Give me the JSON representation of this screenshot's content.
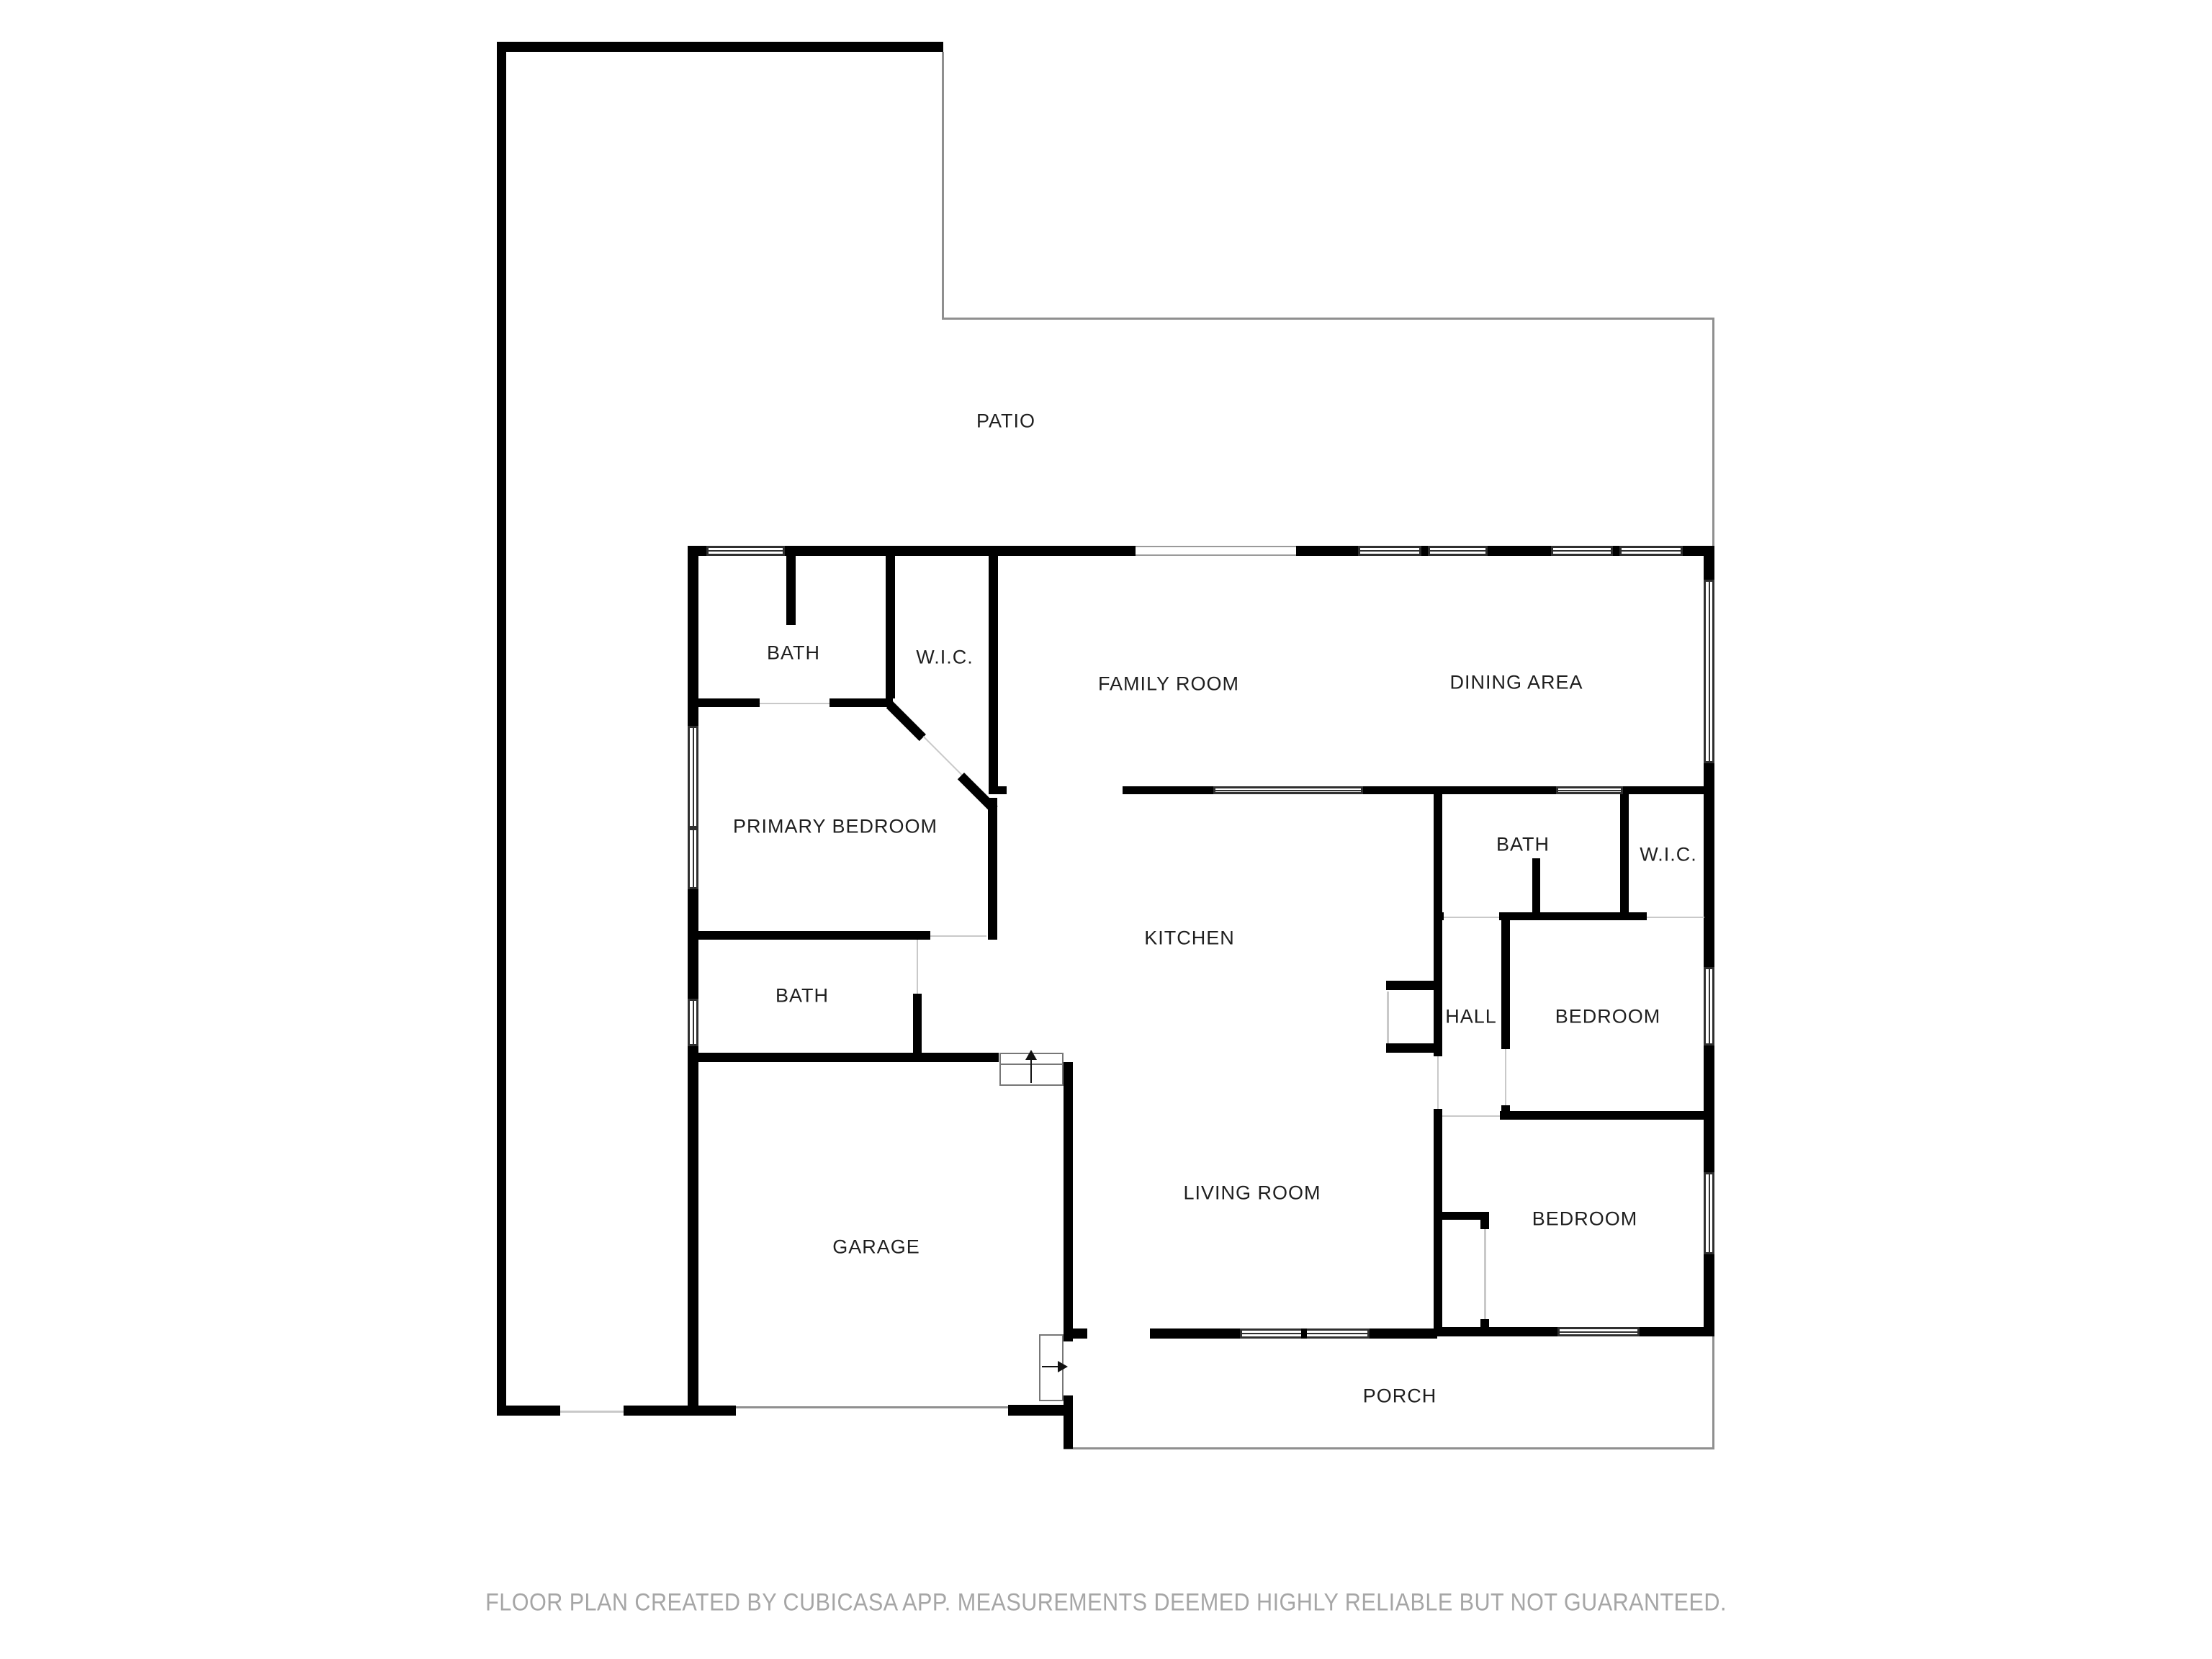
{
  "rooms": {
    "patio": "PATIO",
    "bath_primary": "BATH",
    "wic_primary": "W.I.C.",
    "family_room": "FAMILY ROOM",
    "dining_area": "DINING AREA",
    "primary_bedroom": "PRIMARY BEDROOM",
    "kitchen": "KITCHEN",
    "bath_hall": "BATH",
    "wic_bedroom": "W.I.C.",
    "hall": "HALL",
    "bedroom_ne": "BEDROOM",
    "bath_garage": "BATH",
    "living_room": "LIVING ROOM",
    "garage": "GARAGE",
    "bedroom_se": "BEDROOM",
    "porch": "PORCH"
  },
  "footer": {
    "disclaimer": "FLOOR PLAN CREATED BY CUBICASA APP. MEASUREMENTS DEEMED HIGHLY RELIABLE BUT NOT GUARANTEED."
  },
  "colors": {
    "wall": "#000000",
    "label": "#1f1f1f",
    "footer_text": "#a6a6a6",
    "thin_line": "#8f8f8f"
  }
}
